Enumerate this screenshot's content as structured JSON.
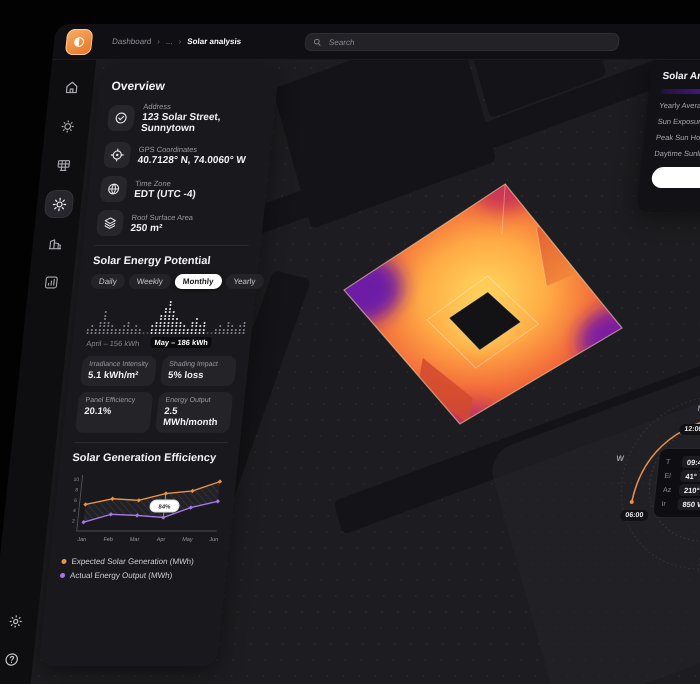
{
  "topbar": {
    "breadcrumb": [
      "Dashboard",
      "...",
      "Solar analysis"
    ],
    "separator": "›",
    "search_placeholder": "Search"
  },
  "sidebar": {
    "items": [
      "home",
      "energy-gear",
      "solar-panel",
      "sun",
      "buildings",
      "analytics"
    ],
    "active": "sun",
    "bottom": [
      "settings",
      "help"
    ]
  },
  "overview": {
    "title": "Overview",
    "fields": [
      {
        "icon": "check-circle",
        "label": "Address",
        "value": "123 Solar Street, Sunnytown"
      },
      {
        "icon": "target",
        "label": "GPS Coordinates",
        "value": "40.7128° N, 74.0060° W"
      },
      {
        "icon": "globe",
        "label": "Time Zone",
        "value": "EDT (UTC -4)"
      },
      {
        "icon": "layers",
        "label": "Roof Surface Area",
        "value": "250 m²"
      }
    ]
  },
  "potential": {
    "title": "Solar Energy Potential",
    "tabs": [
      "Daily",
      "Weekly",
      "Monthly",
      "Yearly"
    ],
    "active_tab": "Monthly",
    "april_summary": "April – 156 kWh",
    "may_summary": "May – 186 kWh"
  },
  "stats": [
    {
      "label": "Irradiance Intensity",
      "value": "5.1 kWh/m²"
    },
    {
      "label": "Shading Impact",
      "value": "5% loss"
    },
    {
      "label": "Panel Efficiency",
      "value": "20.1%"
    },
    {
      "label": "Energy Output",
      "value": "2.5 MWh/month"
    }
  ],
  "efficiency": {
    "title": "Solar Generation Efficiency"
  },
  "right_panel": {
    "title": "Solar Analysis",
    "rows": [
      "Yearly Average",
      "Sun Exposure",
      "Peak Sun Hours",
      "Daytime Sunlight"
    ]
  },
  "compass": {
    "north": "N",
    "west": "W",
    "time_top": "12:00",
    "time_bottom": "06:00",
    "info": [
      {
        "label": "T",
        "value": "09:43AM"
      },
      {
        "label": "El",
        "value": "41°"
      },
      {
        "label": "Az",
        "value": "210°"
      },
      {
        "label": "Ir",
        "value": "850 W/m²"
      }
    ]
  },
  "colors": {
    "accent_orange": "#e8924a",
    "accent_purple": "#a678e8",
    "active_tab_bg": "#ffffff",
    "heatmap_palette": [
      "#ffd95e",
      "#ffab45",
      "#f4703b",
      "#d8453c",
      "#7b1fa2"
    ]
  },
  "chart_data": [
    {
      "type": "bar",
      "title": "Solar Energy Potential (dot-matrix, Monthly)",
      "unit": "kWh",
      "series": [
        {
          "name": "April",
          "total": 156,
          "color": "#87878f",
          "values": [
            2,
            3,
            2,
            4,
            7,
            4,
            3,
            2,
            2,
            3,
            4,
            2,
            3,
            2
          ]
        },
        {
          "name": "May",
          "total": 186,
          "color": "#ecebee",
          "values": [
            3,
            4,
            6,
            8,
            10,
            7,
            5,
            4,
            3,
            2,
            4,
            5,
            3,
            4
          ]
        },
        {
          "name": "June (partial)",
          "total": null,
          "color": "#87878f",
          "values": [
            2,
            3,
            2,
            4,
            3,
            2,
            3,
            4
          ]
        }
      ]
    },
    {
      "type": "line",
      "title": "Solar Generation Efficiency",
      "categories": [
        "Jan",
        "Feb",
        "Mar",
        "Apr",
        "May",
        "Jun"
      ],
      "yticks": [
        0,
        2,
        4,
        6,
        8,
        10
      ],
      "ylim": [
        0,
        10
      ],
      "legend_position": "bottom",
      "series": [
        {
          "name": "Expected Solar Generation (MWh)",
          "color": "#e8924a",
          "values": [
            5.1,
            6.2,
            5.9,
            7.2,
            7.7,
            9.5
          ]
        },
        {
          "name": "Actual Energy Output (MWh)",
          "color": "#a678e8",
          "values": [
            1.7,
            3.2,
            3.0,
            2.6,
            4.5,
            5.7
          ]
        }
      ],
      "annotation": {
        "category": "Apr",
        "label": "84%"
      }
    }
  ]
}
